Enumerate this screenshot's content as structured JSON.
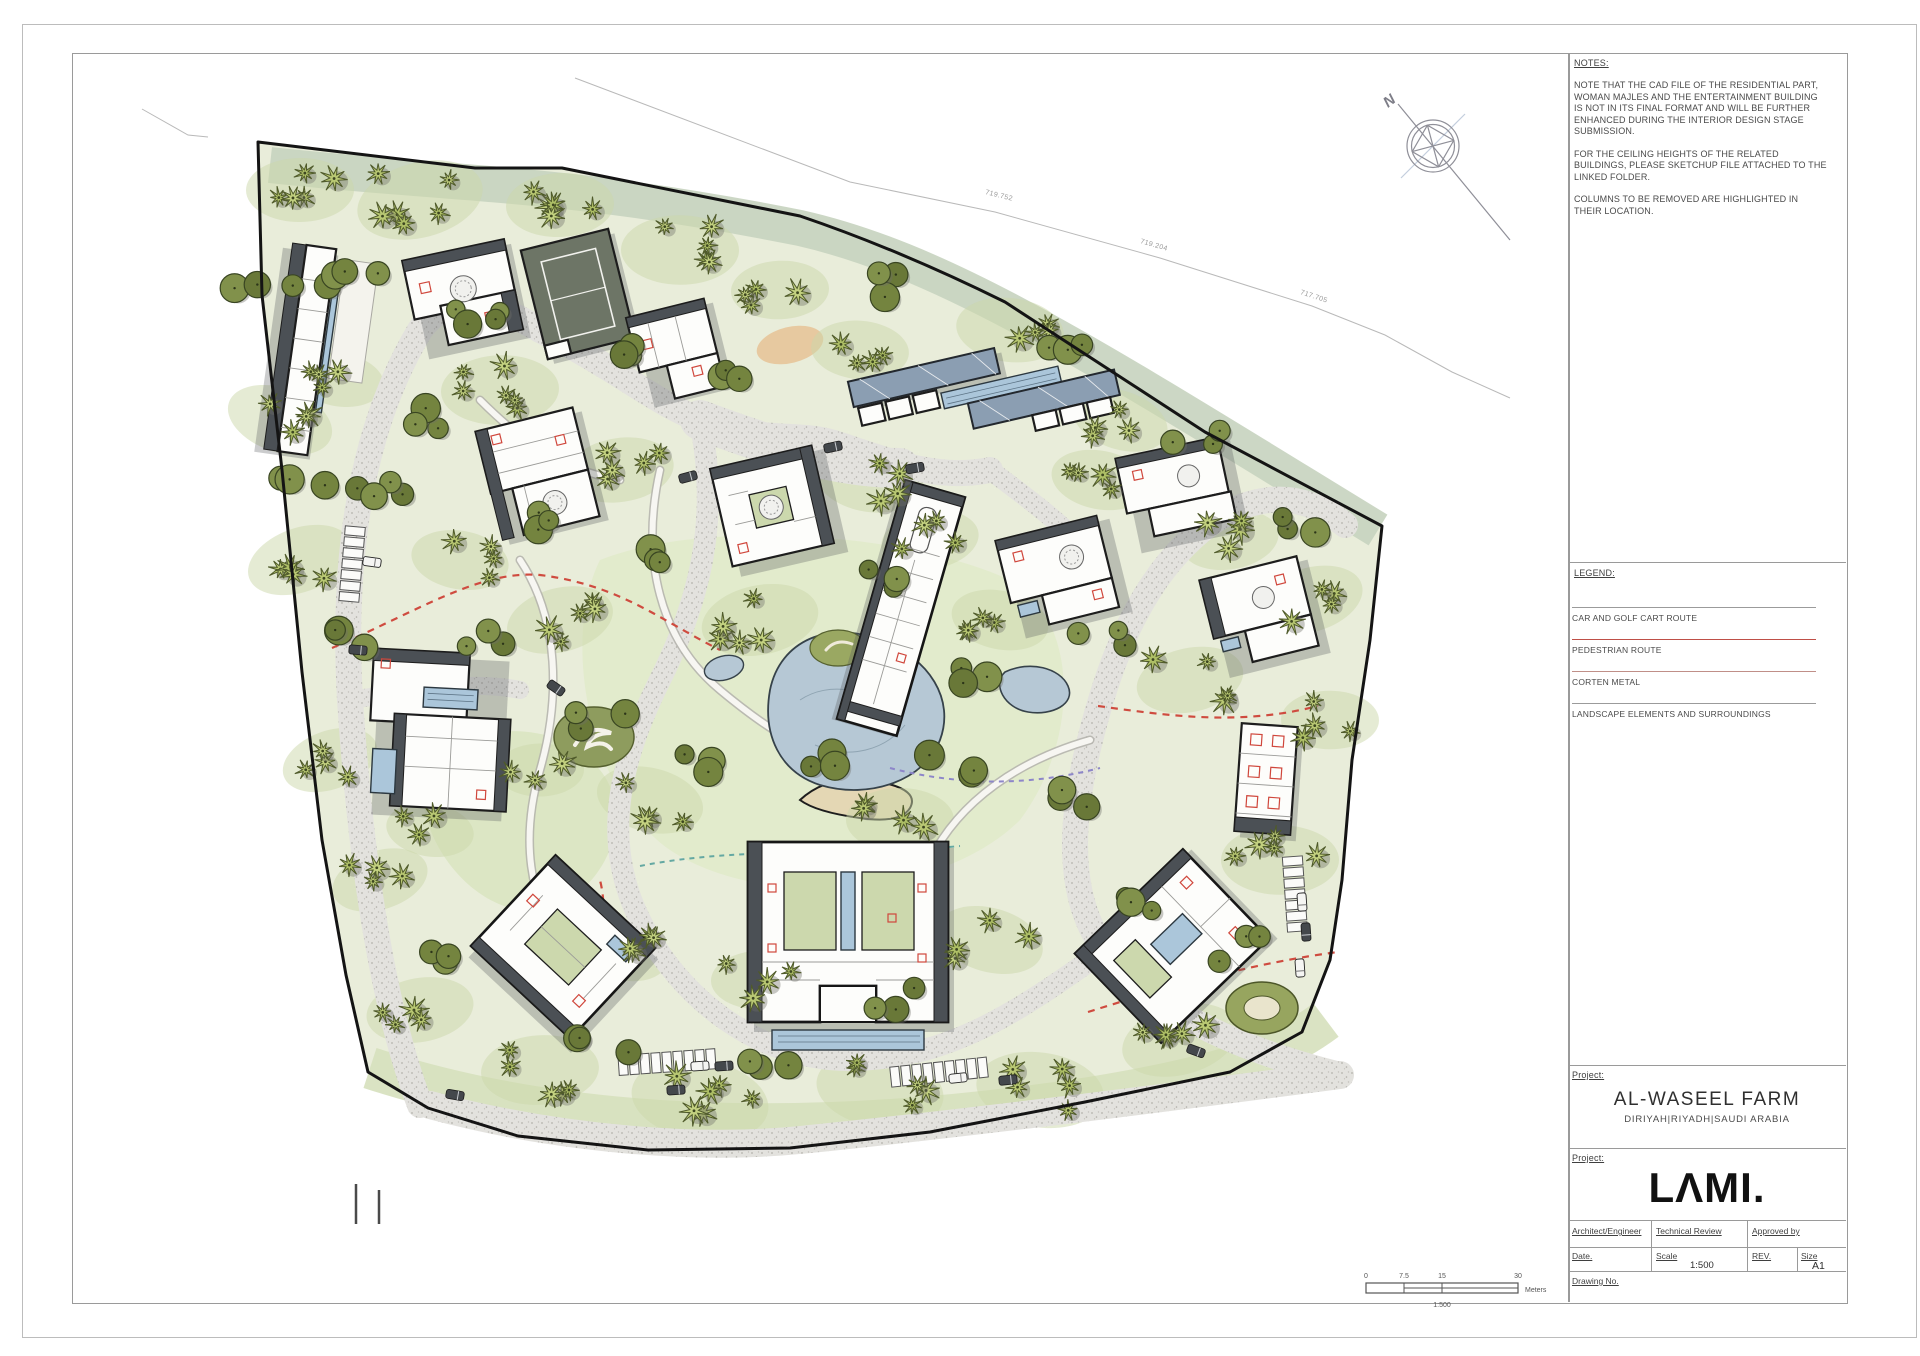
{
  "sheet": {
    "notes": {
      "heading": "NOTES:",
      "paragraphs": [
        "NOTE THAT THE CAD FILE OF THE RESIDENTIAL PART, WOMAN MAJLES AND THE ENTERTAINMENT BUILDING IS NOT IN ITS FINAL FORMAT AND WILL BE FURTHER ENHANCED DURING THE INTERIOR DESIGN STAGE SUBMISSION.",
        "FOR THE CEILING HEIGHTS OF THE RELATED BUILDINGS, PLEASE SKETCHUP FILE ATTACHED TO THE LINKED FOLDER.",
        "COLUMNS TO BE REMOVED ARE HIGHLIGHTED IN THEIR LOCATION."
      ]
    },
    "legend": {
      "heading": "LEGEND:",
      "items": [
        {
          "label": "CAR AND GOLF CART ROUTE",
          "color": "#9b9b9b"
        },
        {
          "label": "PEDESTRIAN ROUTE",
          "color": "#bf4f47"
        },
        {
          "label": "CORTEN METAL",
          "color": "#c08f88"
        },
        {
          "label": "LANDSCAPE ELEMENTS AND SURROUNDINGS",
          "color": "#9b9b9b"
        }
      ]
    },
    "project": {
      "label": "Project:",
      "name": "AL-WASEEL FARM",
      "location": "DIRIYAH|RIYADH|SAUDI ARABIA"
    },
    "firm": {
      "label": "Project:",
      "logo": "LΛMI."
    },
    "titleblock": {
      "architect_label": "Architect/Engineer",
      "technical_review_label": "Technical Review",
      "approved_label": "Approved by",
      "date_label": "Date.",
      "scale_label": "Scale",
      "scale_value": "1:500",
      "rev_label": "REV.",
      "size_label": "Size",
      "size_value": "A1",
      "drawing_no_label": "Drawing No."
    },
    "plan": {
      "north_label": "N",
      "survey_labels": [
        "719.752",
        "719.204",
        "717.705"
      ],
      "scale_bar": {
        "ticks": [
          "0",
          "7.5",
          "15",
          "30"
        ],
        "unit": "Meters",
        "ratio": "1:500"
      }
    }
  }
}
